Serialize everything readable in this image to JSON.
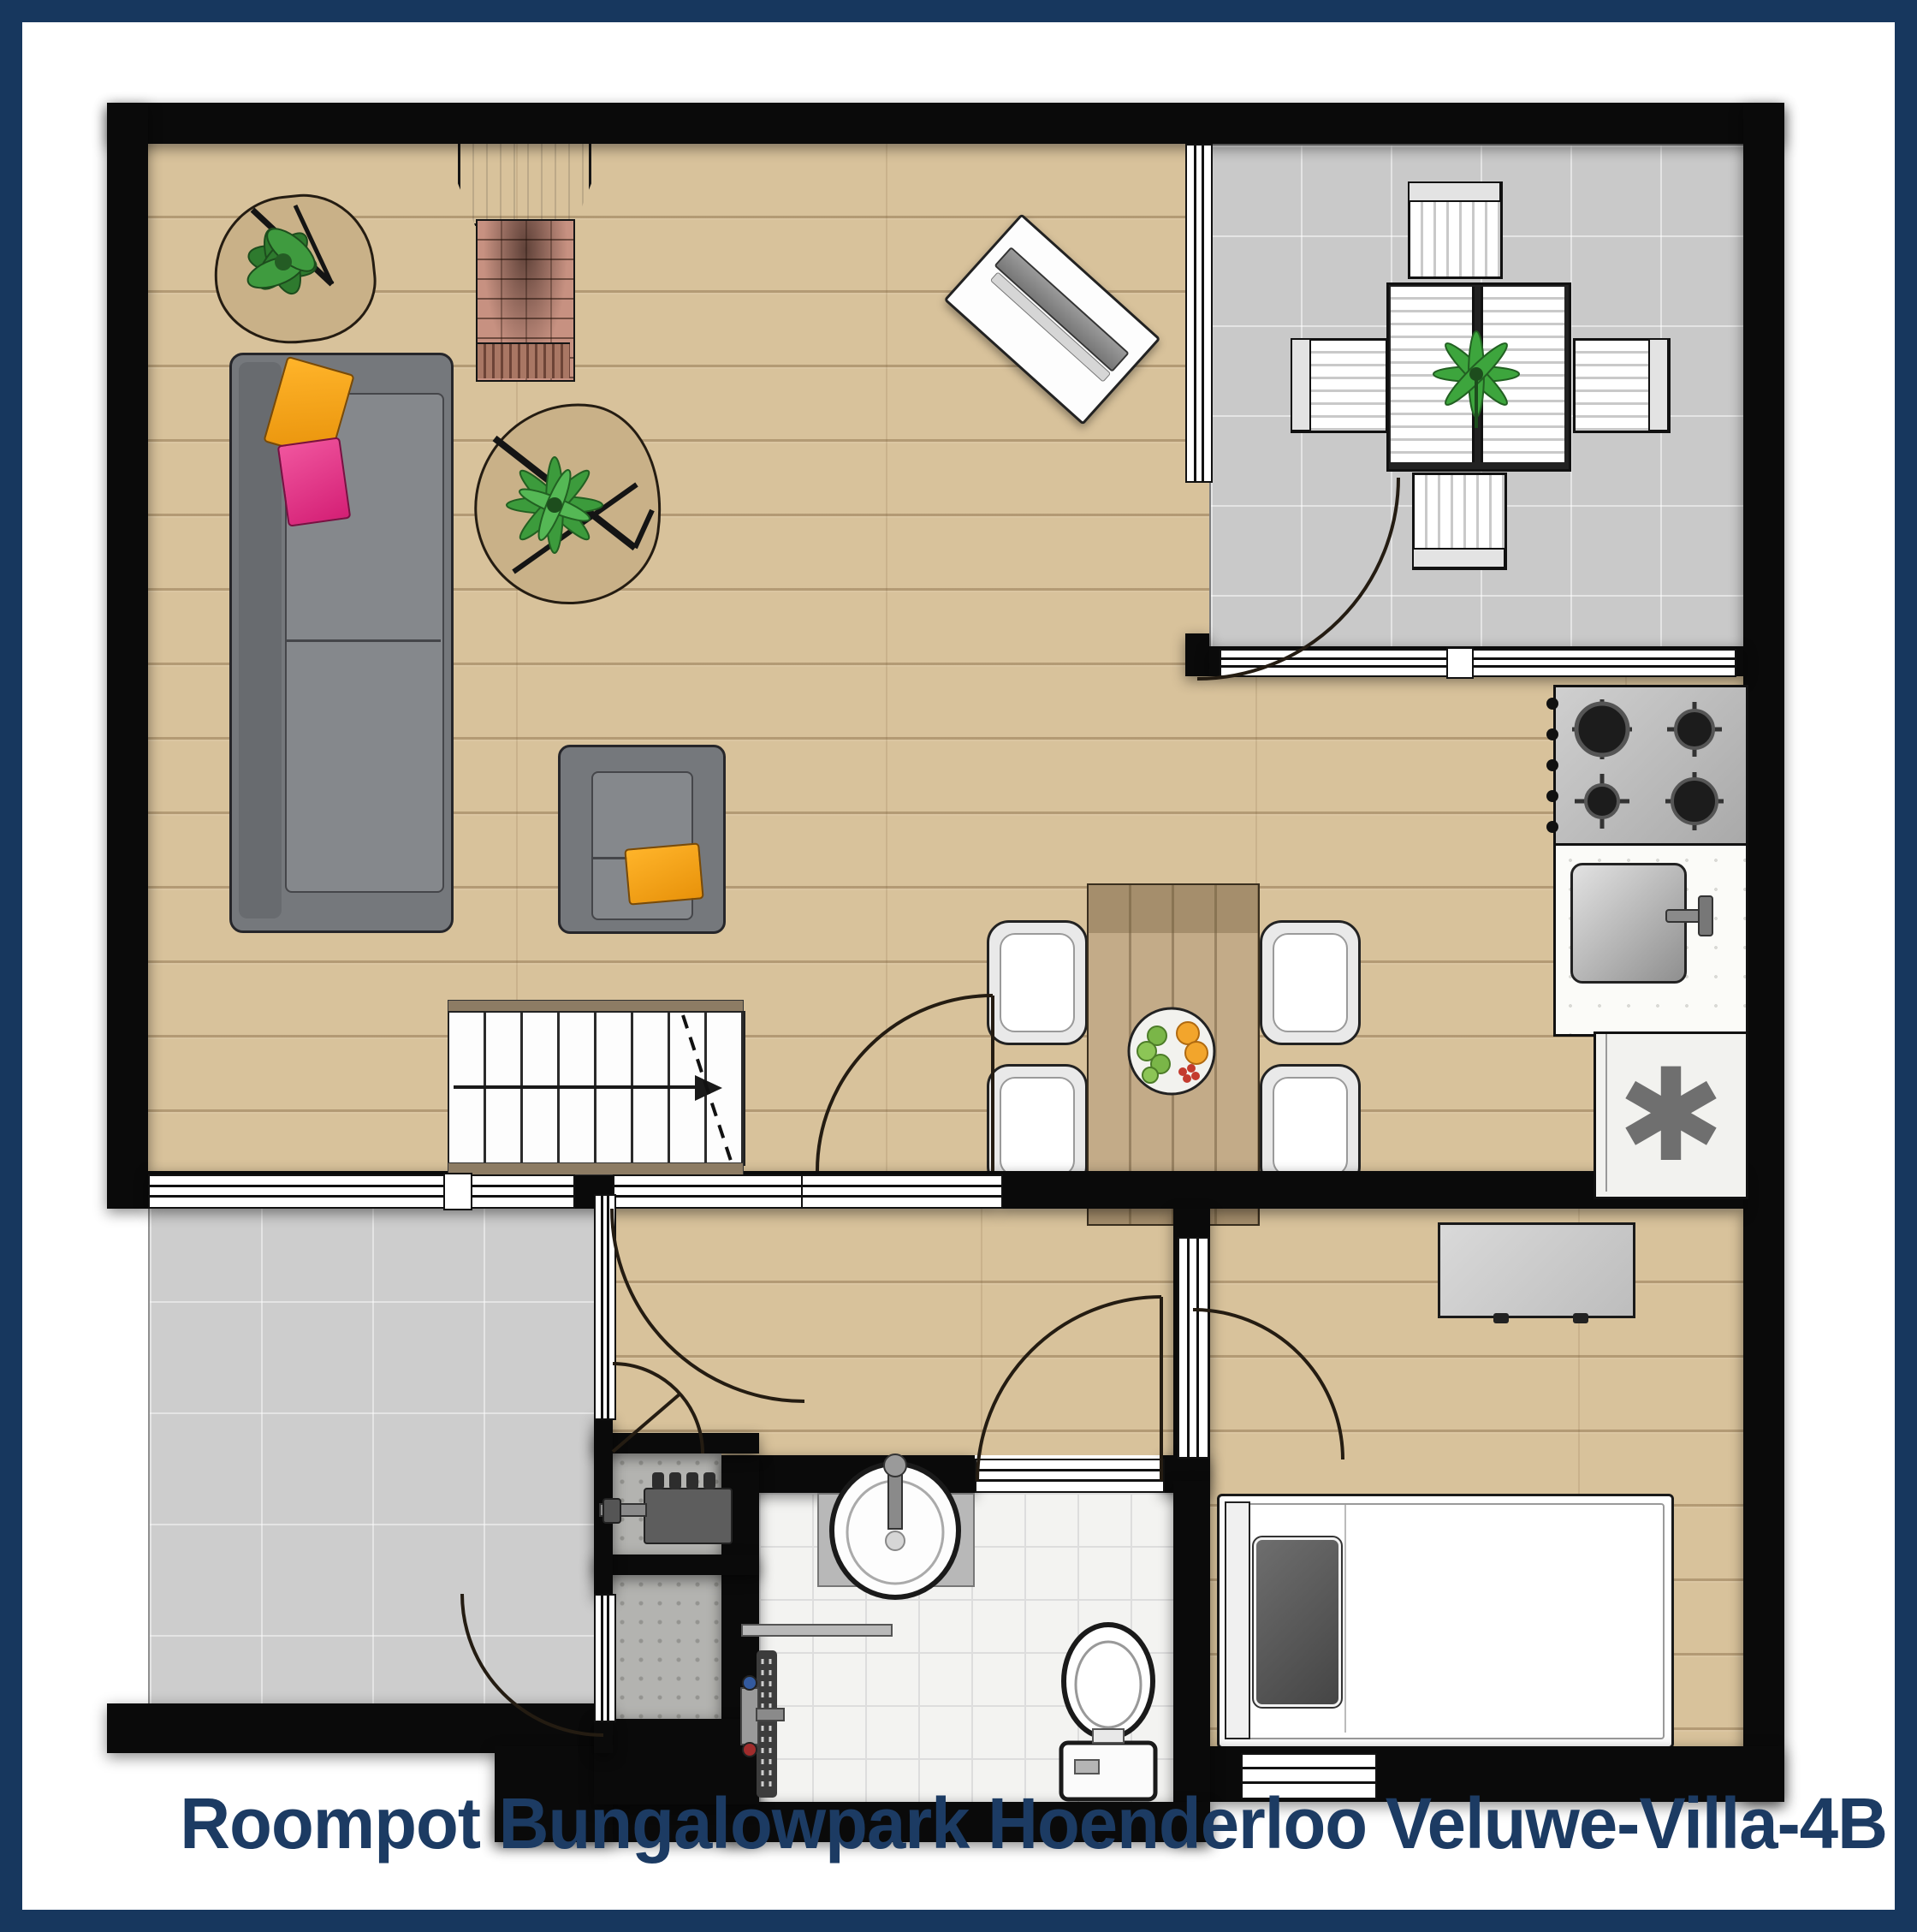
{
  "title": {
    "text": "Roompot Bungalowpark Hoenderloo Veluwe-Villa-4B"
  },
  "fixtures": {
    "freezer_symbol": "✱"
  },
  "palette": {
    "frame_navy": "#17375e",
    "wall_black": "#0a0a0a",
    "wood_floor": "#d8c29b",
    "terrace_tile": "#c9c9c9",
    "patio_tile": "#cdcdcd",
    "bath_tile": "#f3f3f1",
    "concrete": "#b3b3b0",
    "sofa_gray": "#75787c",
    "pillow_orange": "#f2a41e",
    "pillow_pink": "#e8388a",
    "rug_tan": "#c9b188",
    "plant_green": "#3c9b3c",
    "table_wood": "#c3ab88",
    "chair_light": "#e9e9e9",
    "title_navy": "#1c3b63"
  },
  "plan": {
    "type": "floor-plan",
    "rooms": [
      {
        "name": "living-room",
        "floor": "wood"
      },
      {
        "name": "open-kitchen",
        "floor": "wood"
      },
      {
        "name": "roofed-terrace-north-east",
        "floor": "gray-tile"
      },
      {
        "name": "patio-south-west",
        "floor": "gray-tile"
      },
      {
        "name": "hallway",
        "floor": "wood"
      },
      {
        "name": "technical-closet",
        "floor": "concrete"
      },
      {
        "name": "storage-vestibule",
        "floor": "concrete"
      },
      {
        "name": "bathroom",
        "floor": "white-tile"
      },
      {
        "name": "bedroom",
        "floor": "wood"
      }
    ],
    "furniture": [
      "sofa-with-orange-and-pink-pillows",
      "armchair-with-orange-pillow",
      "rug-with-plant-top-left",
      "rug-with-plant-center",
      "wood-stove-fireplace",
      "wall-tv-angled",
      "dining-table-with-fruit-bowl",
      "four-dining-chairs",
      "staircase-up",
      "outdoor-table-with-plant",
      "four-outdoor-chairs",
      "gas-hob-4-burners",
      "kitchen-sink",
      "freezer-appliance",
      "boiler-with-lightning-symbol",
      "washbasin",
      "shower-with-drain",
      "toilet",
      "wardrobe-dresser",
      "single-bed-with-gray-pillow"
    ]
  }
}
